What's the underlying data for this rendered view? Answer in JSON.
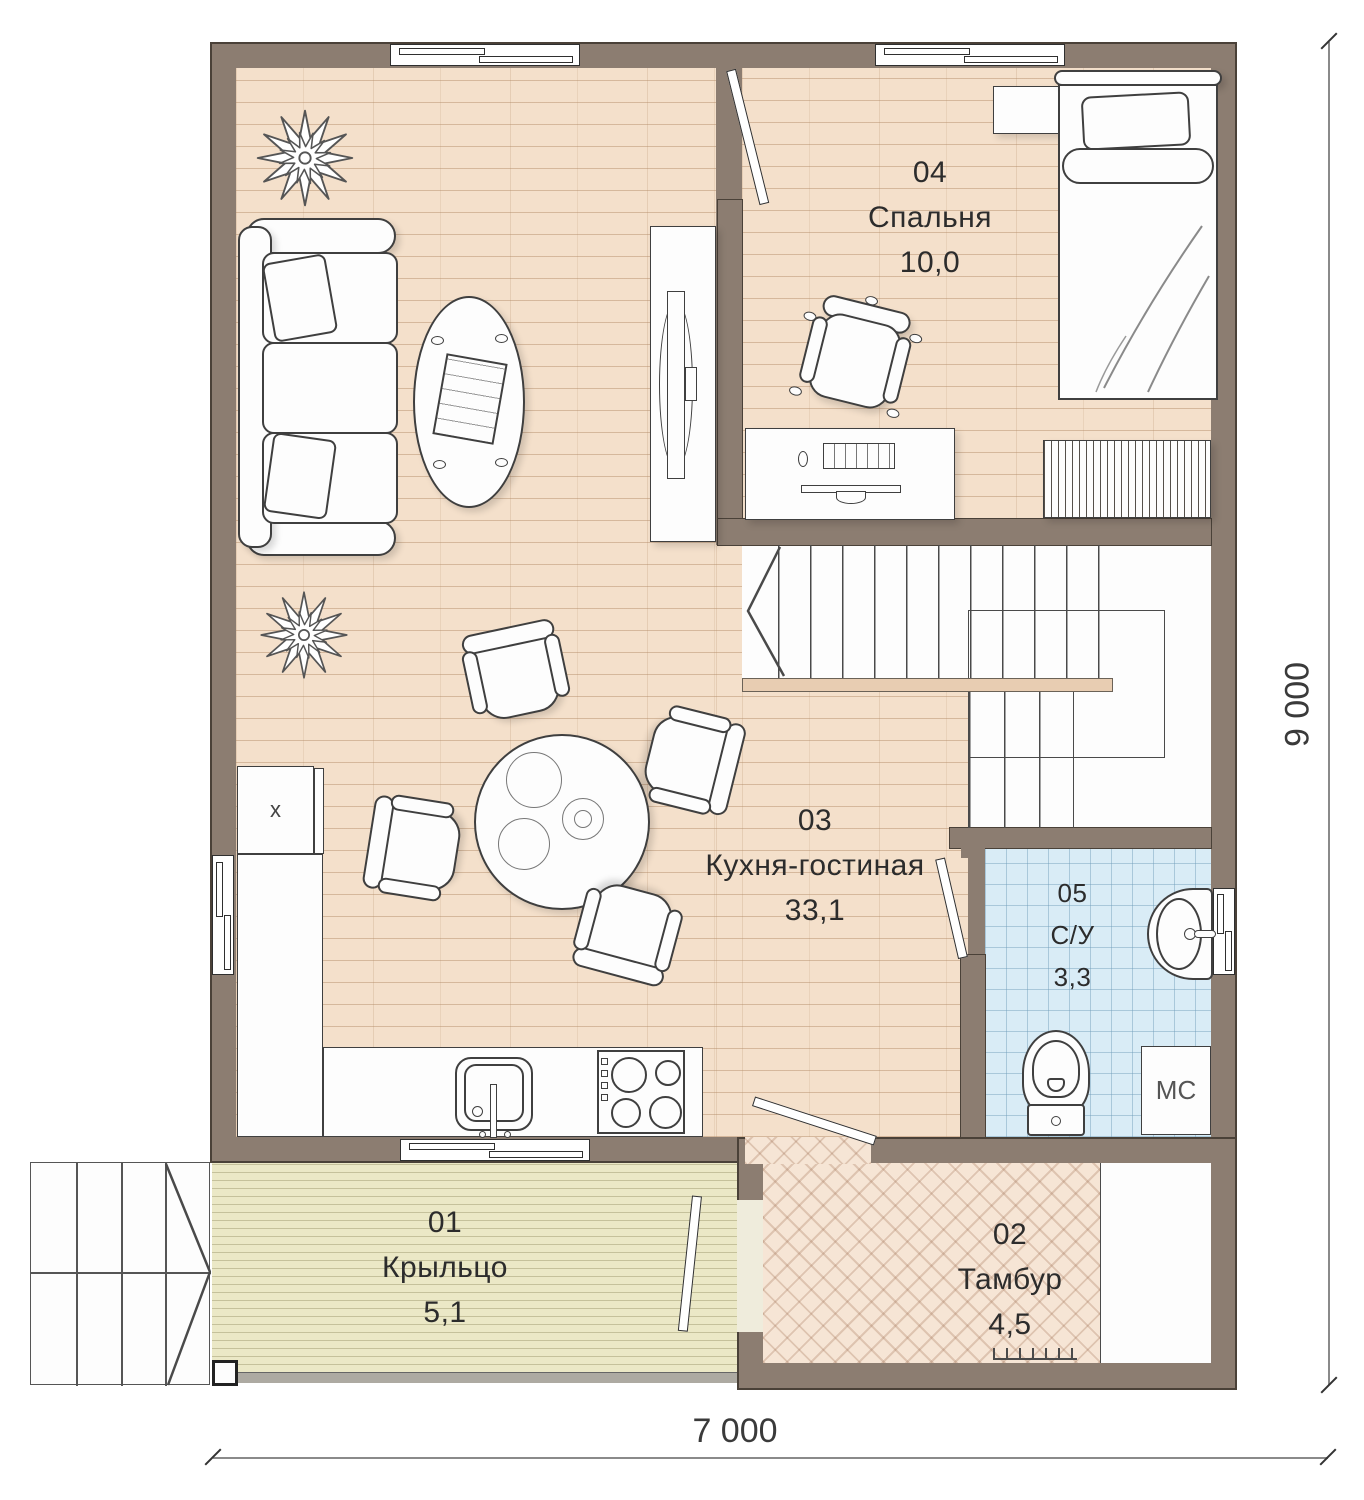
{
  "floor_plan": {
    "rooms": [
      {
        "number": "01",
        "name": "Крыльцо",
        "area": "5,1"
      },
      {
        "number": "02",
        "name": "Тамбур",
        "area": "4,5"
      },
      {
        "number": "03",
        "name": "Кухня-гостиная",
        "area": "33,1"
      },
      {
        "number": "04",
        "name": "Спальня",
        "area": "10,0"
      },
      {
        "number": "05",
        "name": "С/У",
        "area": "3,3"
      }
    ],
    "appliance_labels": {
      "washing_machine": "МС",
      "fridge": "х"
    },
    "dimensions": {
      "width_label": "7 000",
      "height_label": "9 000"
    },
    "colors": {
      "wall": "#8c7d71",
      "wood_floor": "#f4e0cb",
      "tile_floor": "#d9ecf6",
      "deck_floor": "#ebe8c6",
      "herringbone_floor": "#f6e5d5",
      "stair_rail": "#e8cdb2"
    }
  }
}
